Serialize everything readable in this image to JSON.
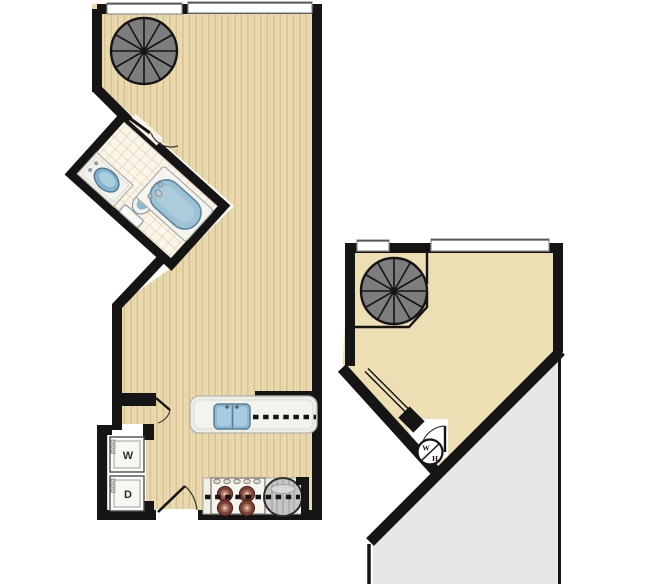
{
  "floor_plan": {
    "background": "#ffffff",
    "levels": [
      {
        "id": "lower-level",
        "features": [
          "spiral-staircase",
          "bathroom-vanity-sink",
          "toilet",
          "bathtub",
          "kitchen-peninsula-sink",
          "upper-cabinets-dashed-line",
          "range-4-burner",
          "round-appliance",
          "stacked-washer-dryer-closet",
          "entry-door",
          "bathroom-door",
          "laundry-closet-door"
        ],
        "window_count": 2
      },
      {
        "id": "upper-loft-level",
        "features": [
          "spiral-staircase",
          "stair-railing",
          "open-stair-railing",
          "water-heater",
          "loft-closet-door",
          "void-below-roof-area"
        ],
        "window_count": 2
      }
    ]
  },
  "labels": {
    "washer": "W",
    "dryer": "D",
    "water_heater_top": "W",
    "water_heater_bottom": "H"
  },
  "colors": {
    "wall": "#151515",
    "wood_floor": "#ecdbb0",
    "wood_grain": "#d9c392",
    "loft_floor": "#eddeb4",
    "bath_tile": "#faf5e8",
    "tile_grid": "#d7c7a0",
    "tub_blue": "#9cc2d6",
    "sink_blue": "#85b3cd",
    "stair_gray": "#7d7d7d",
    "void_gray": "#e7e7e6",
    "counter_white": "#efefea",
    "burner_red": "#7c4036",
    "appliance_gray": "#c6c6c6",
    "window_white": "#ffffff"
  }
}
